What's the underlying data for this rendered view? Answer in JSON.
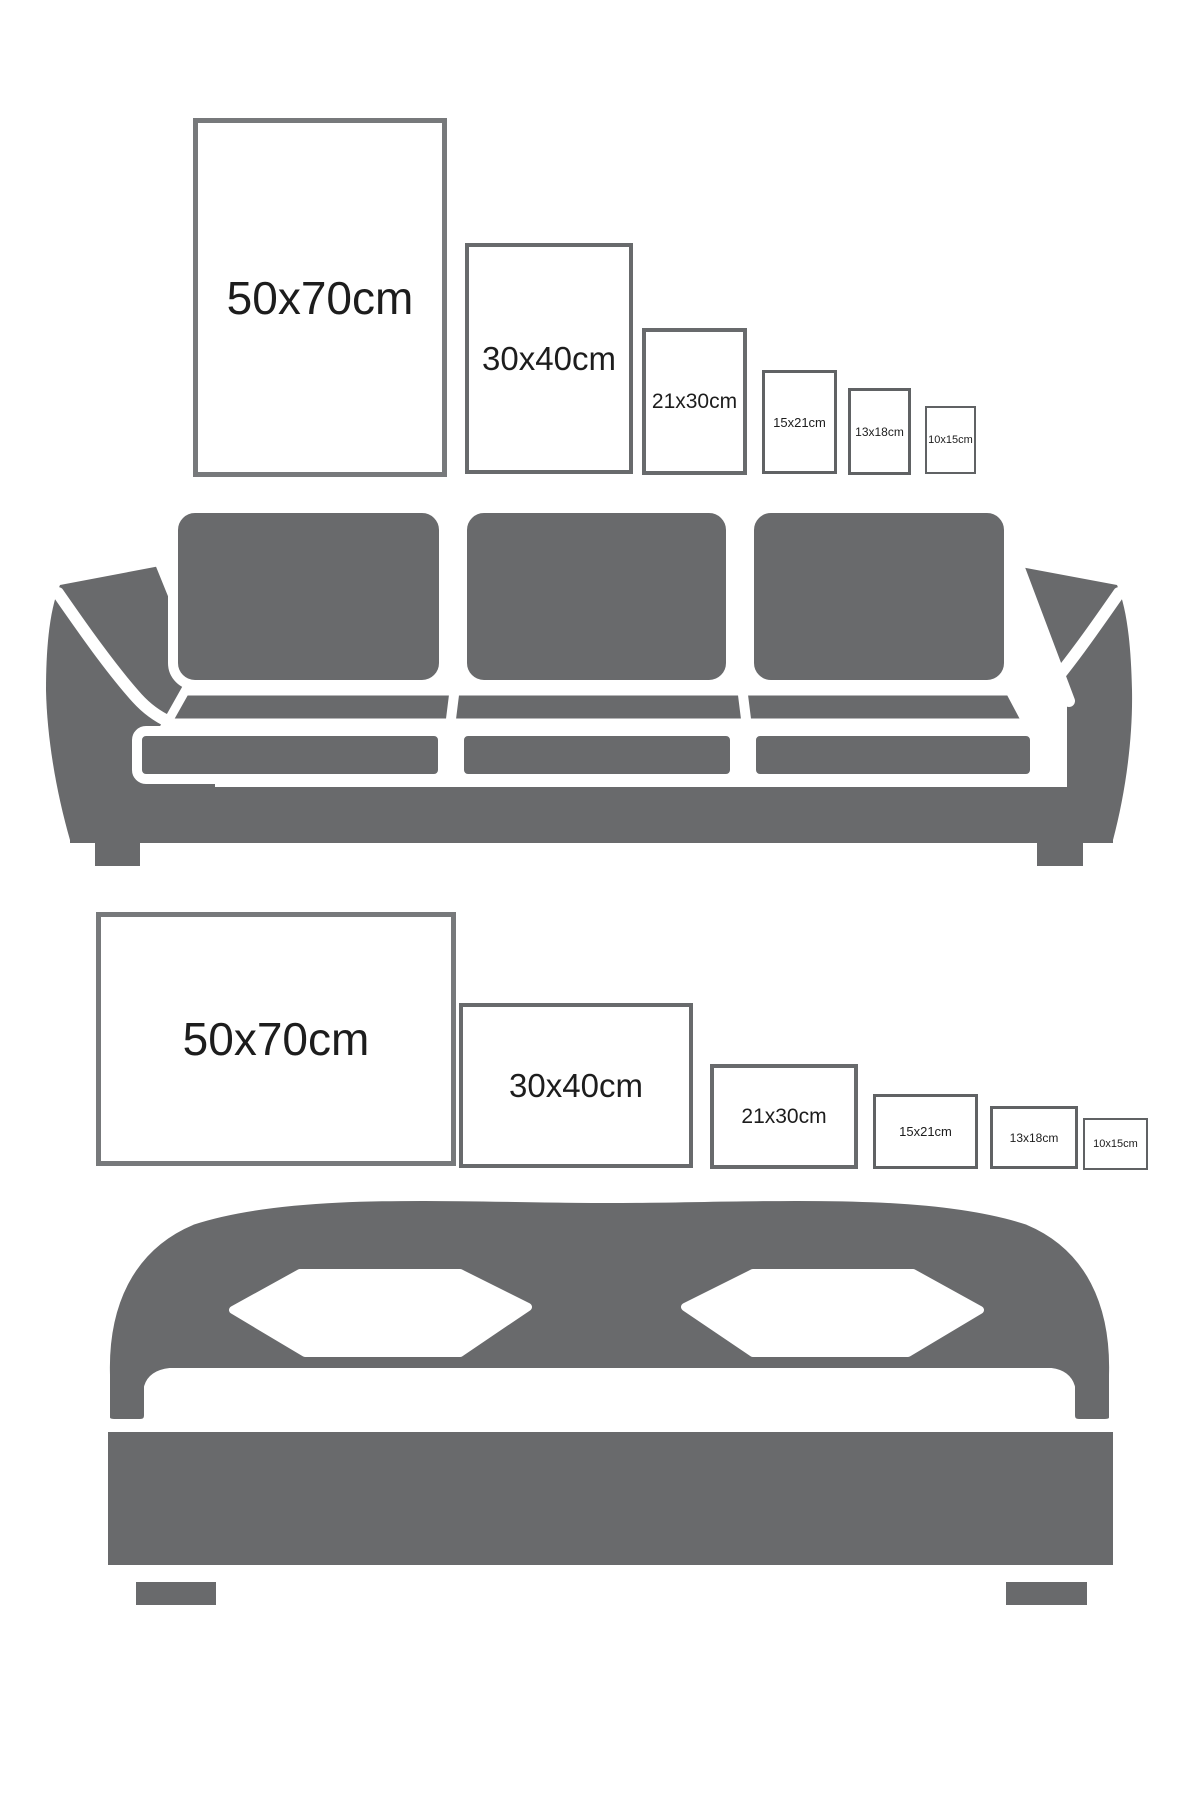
{
  "colors": {
    "background": "#ffffff",
    "furniture_gray": "#696a6c",
    "separator_white": "#ffffff",
    "label_text": "#1d1d1d",
    "frame_border_large": "#77797b",
    "frame_border_medium": "#686a6c",
    "frame_border_small": "#606264"
  },
  "sofa_row": {
    "orientation": "portrait",
    "frames": [
      {
        "label": "50x70cm"
      },
      {
        "label": "30x40cm"
      },
      {
        "label": "21x30cm"
      },
      {
        "label": "15x21cm"
      },
      {
        "label": "13x18cm"
      },
      {
        "label": "10x15cm"
      }
    ]
  },
  "bed_row": {
    "orientation": "landscape",
    "frames": [
      {
        "label": "50x70cm"
      },
      {
        "label": "30x40cm"
      },
      {
        "label": "21x30cm"
      },
      {
        "label": "15x21cm"
      },
      {
        "label": "13x18cm"
      },
      {
        "label": "10x15cm"
      }
    ]
  },
  "icons": {
    "sofa": "sofa-icon",
    "bed": "bed-icon"
  }
}
